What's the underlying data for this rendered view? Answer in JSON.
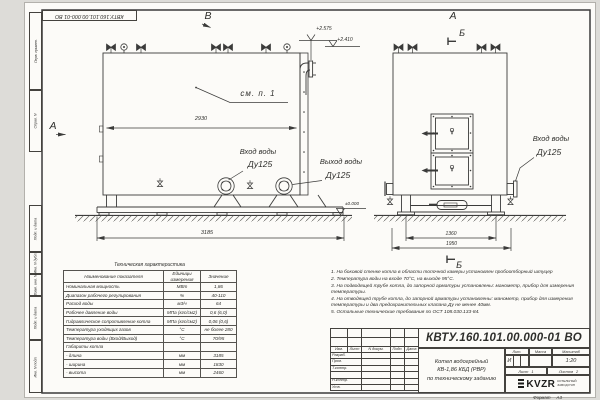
{
  "doc_number": "КВТУ.160.101.00.000-01  ВО",
  "doc_number_top": "КВТУ.160.101.00.000-01 ВО",
  "frame_labels": [
    "Перв. примен.",
    "Справ. N",
    "Подп. и дата",
    "Инв. N дубл.",
    "Взам. инв. N",
    "Подп. и дата",
    "Инв. N подл."
  ],
  "views": {
    "top_view_mark": "В",
    "front_view_mark": "А",
    "side_view_mark": "А",
    "section_mark_top": "Б",
    "section_mark_bottom": "Б",
    "see_note": "см. п. 1"
  },
  "dimensions": {
    "body_length": "2930",
    "total_length": "3185",
    "support_width": "1360",
    "total_width": "1950"
  },
  "elevations": {
    "pipe_top": "+2.575",
    "outlet": "+2.410",
    "ground": "±0.000"
  },
  "pipe_labels": {
    "inlet_side": {
      "line1": "Вход воды",
      "line2": "Ду125"
    },
    "outlet_side": {
      "line1": "Выход воды",
      "line2": "Ду125"
    },
    "inlet_front": {
      "line1": "Вход воды",
      "line2": "Ду125"
    }
  },
  "tech_table": {
    "title": "Техническая характеристика",
    "headers": [
      "Наименование показателя",
      "Единицы измерения",
      "Значение"
    ],
    "rows": [
      [
        "Номинальная мощность",
        "МВт",
        "1,86"
      ],
      [
        "Диапазон рабочего регулирования",
        "%",
        "40-110"
      ],
      [
        "Расход воды",
        "м3/ч",
        "64"
      ],
      [
        "Рабочее давление воды",
        "МПа (кгс/см2)",
        "0,6 (6,0)"
      ],
      [
        "Гидравлическое сопротивление котла",
        "МПа (кгс/см2)",
        "0,06 (0,6)"
      ],
      [
        "Температура уходящих газов",
        "°С",
        "не более 280"
      ],
      [
        "Температура воды (Вход/Выход)",
        "°С",
        "70/95"
      ],
      [
        "Габариты котла",
        "",
        ""
      ],
      [
        "   - длина",
        "мм",
        "3185"
      ],
      [
        "   - ширина",
        "мм",
        "1830"
      ],
      [
        "   - высота",
        "мм",
        "2460"
      ]
    ]
  },
  "notes": [
    "1.  На боковой стенке котла в области топочной камеры установлен пробоотборный штуцер",
    "2.  Температура воды на входе 70°С, на выходе 95°С.",
    "3.  На подводящей трубе котла, до запорной арматуры установлены: манометр, прибор для измерения температуры.",
    "4.  На отводящей трубе котла, до запорной арматуры установлены: манометр, прибор для измерения температуры и два предохранительных клапана Ду не менее 40мм.",
    "5.  Остальные технические требования по ОСТ  108.030.133-84."
  ],
  "title_block": {
    "rev_cols": [
      "Изм.",
      "Лист",
      "N докум.",
      "Подп.",
      "Дата"
    ],
    "rows": [
      "Разраб.",
      "Пров.",
      "Т.контр.",
      "",
      "Н.контр.",
      "Утв."
    ],
    "product": [
      "Котел водогрейный",
      "КВ-1,86 КБД (РВР)",
      "по техническому заданию"
    ],
    "lit": {
      "label": "Лит.",
      "value": "И"
    },
    "mass": {
      "label": "Масса",
      "value": ""
    },
    "scale": {
      "label": "Масштаб",
      "value": "1:20"
    },
    "sheet": {
      "label": "Лист",
      "value": "1"
    },
    "sheets": {
      "label": "Листов",
      "value": "2"
    },
    "logo": {
      "name": "KVZR",
      "sub1": "КОТЕЛЬНЫЙ",
      "sub2": "ЗАВОД РЭП"
    }
  },
  "format_note": {
    "label": "Формат",
    "value": "А3"
  }
}
